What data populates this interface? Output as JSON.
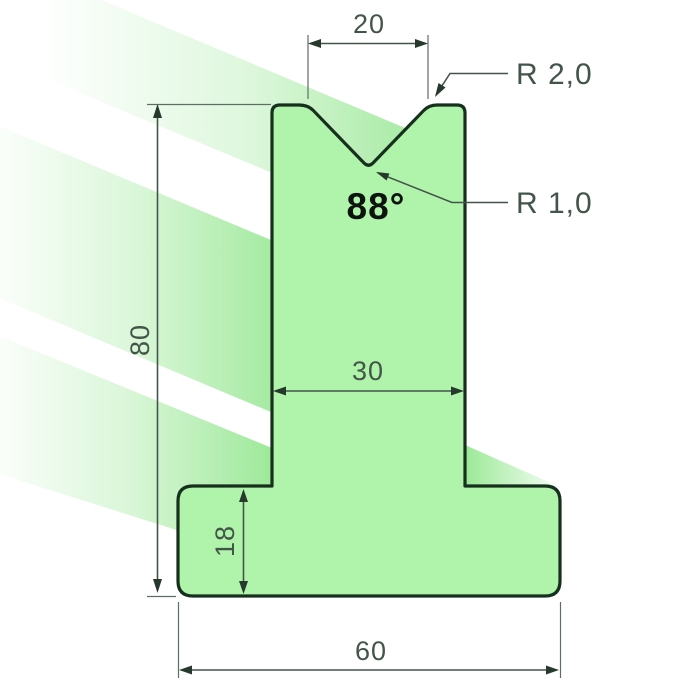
{
  "drawing": {
    "title": "T-die profile technical drawing",
    "labels": {
      "top_width": "20",
      "radius_top": "R 2,0",
      "radius_bottom": "R 1,0",
      "angle": "88°",
      "stem_width": "30",
      "total_height": "80",
      "base_height": "18",
      "base_width": "60"
    },
    "colors": {
      "body": "#b0f4ab",
      "outline": "#16301d",
      "dimension": "#435549",
      "angle_text": "#0d130e",
      "glow": "#86e381"
    }
  }
}
